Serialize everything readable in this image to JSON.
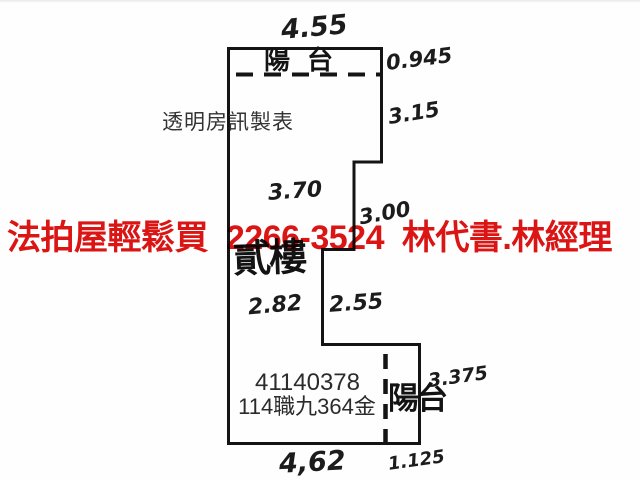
{
  "colors": {
    "watermark_red": "#dc1414",
    "line_black": "#141414",
    "print_gray": "#2b2b2b",
    "background": "#fefefe"
  },
  "watermark": {
    "text": "法拍屋輕鬆買  2266-3524  林代書.林經理"
  },
  "plan": {
    "maker_label": "透明房訊製表",
    "floor_label": "貳樓",
    "top_balcony": {
      "label": "陽台"
    },
    "bottom_balcony": {
      "label": "陽台"
    },
    "case_number": "41140378",
    "case_reference": "114職九364金",
    "dimensions": {
      "top_width": "4.55",
      "top_balcony_depth": "0.945",
      "right_upper": "3.15",
      "interior_upper": "3.70",
      "right_middle": "3.00",
      "interior_lower_left": "2.82",
      "interior_lower_right": "2.55",
      "bottom_balcony_right": "3.375",
      "bottom_width": "4,62",
      "bottom_balcony_width": "1.125"
    }
  }
}
